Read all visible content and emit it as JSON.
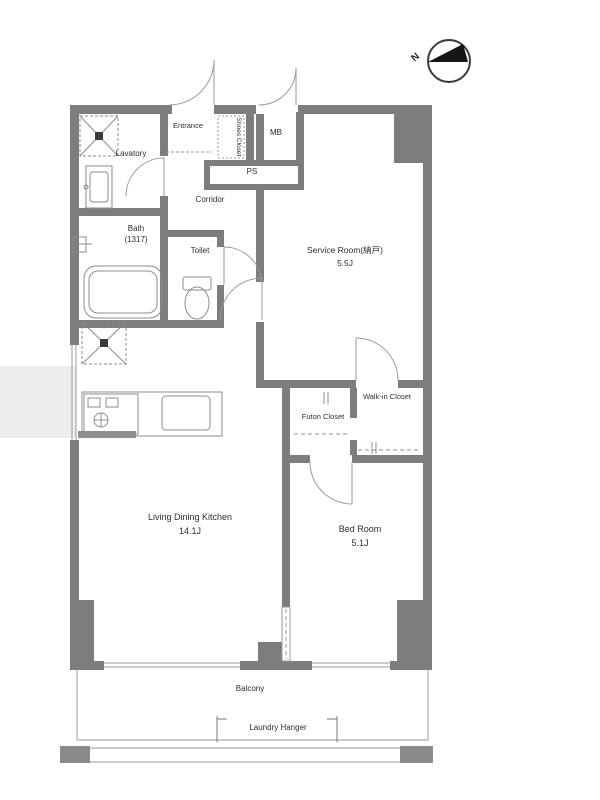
{
  "plan": {
    "compass": {
      "north": "N"
    },
    "rooms": {
      "lavatory": {
        "label": "Lavatory"
      },
      "bath": {
        "label": "Bath",
        "size": "(1317)"
      },
      "toilet": {
        "label": "Toilet"
      },
      "entrance": {
        "label": "Entrance"
      },
      "shoes_closet": {
        "label": "Shoes Closet"
      },
      "meter_box": {
        "label": "MB"
      },
      "pipe_space": {
        "label": "PS"
      },
      "corridor": {
        "label": "Corridor"
      },
      "service_room": {
        "label": "Service Room(納戸)",
        "size": "5.5J"
      },
      "futon_closet": {
        "label": "Futon Closet"
      },
      "walk_in_closet": {
        "label": "Walk-in Closet"
      },
      "living_dining_kitchen": {
        "label": "Living Dining Kitchen",
        "size": "14.1J"
      },
      "bed_room": {
        "label": "Bed Room",
        "size": "5.1J"
      },
      "balcony": {
        "label": "Balcony"
      },
      "laundry_hanger": {
        "label": "Laundry Hanger"
      }
    },
    "colors": {
      "wall": "#7d7d7d",
      "line": "#9a9a9a",
      "text": "#2e2e2e"
    }
  }
}
